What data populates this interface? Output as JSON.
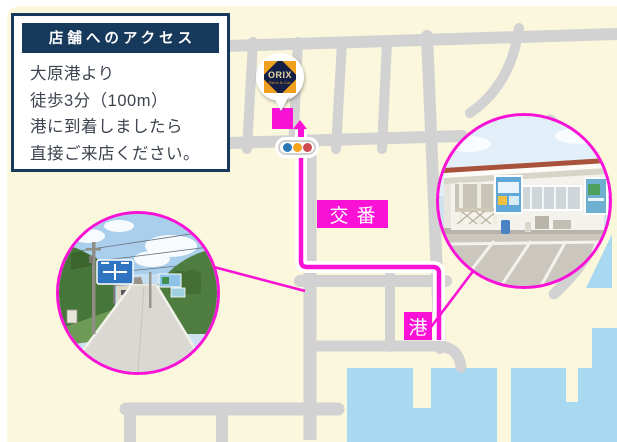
{
  "info_box": {
    "title": "店舗へのアクセス",
    "lines": [
      "大原港より",
      "徒歩3分（100m）",
      "港に到着しましたら",
      "直接ご来店ください。"
    ]
  },
  "marker": {
    "brand": "ORIX",
    "sub": "Rent-A-Car"
  },
  "map_labels": {
    "police": "交番",
    "port": "港"
  },
  "icons": {
    "store_marker": "balloon-pin",
    "traffic_light": "traffic-light",
    "route_arrow": "arrow-up"
  },
  "colors": {
    "background": "#fbf7dc",
    "road": "#d2d2d2",
    "water": "#a9d9f0",
    "route_accent": "#f911d6",
    "navy": "#17395c",
    "traffic_blue": "#2878b8",
    "traffic_orange": "#f6a41c",
    "traffic_red": "#cc4a50"
  }
}
